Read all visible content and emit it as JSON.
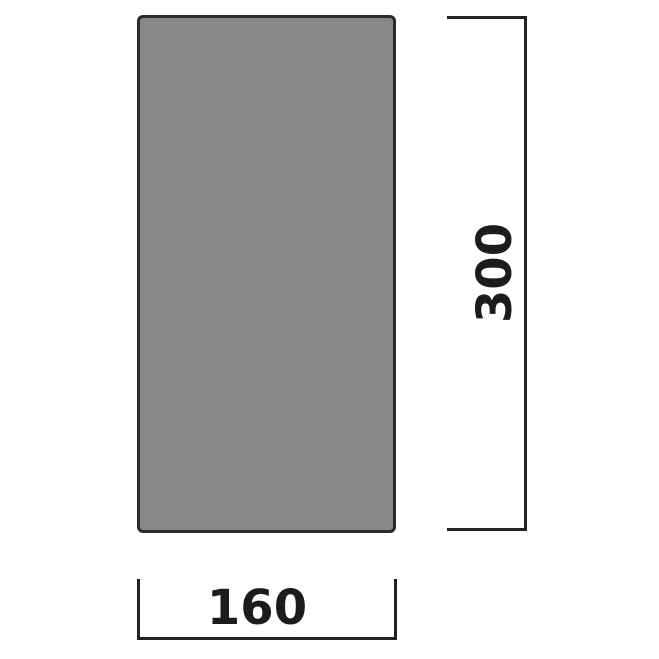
{
  "diagram": {
    "type": "dimensioned-technical-drawing",
    "shape": "rectangle",
    "colors": {
      "panel_fill": "#878787",
      "panel_border": "#2b2b2f",
      "dimension_line": "#222226",
      "label_text": "#1c1c1e",
      "background": "#ffffff"
    },
    "dimensions": {
      "height": {
        "label": "300",
        "orientation": "vertical",
        "position": "right"
      },
      "width": {
        "label": "160",
        "orientation": "horizontal",
        "position": "bottom"
      }
    }
  }
}
